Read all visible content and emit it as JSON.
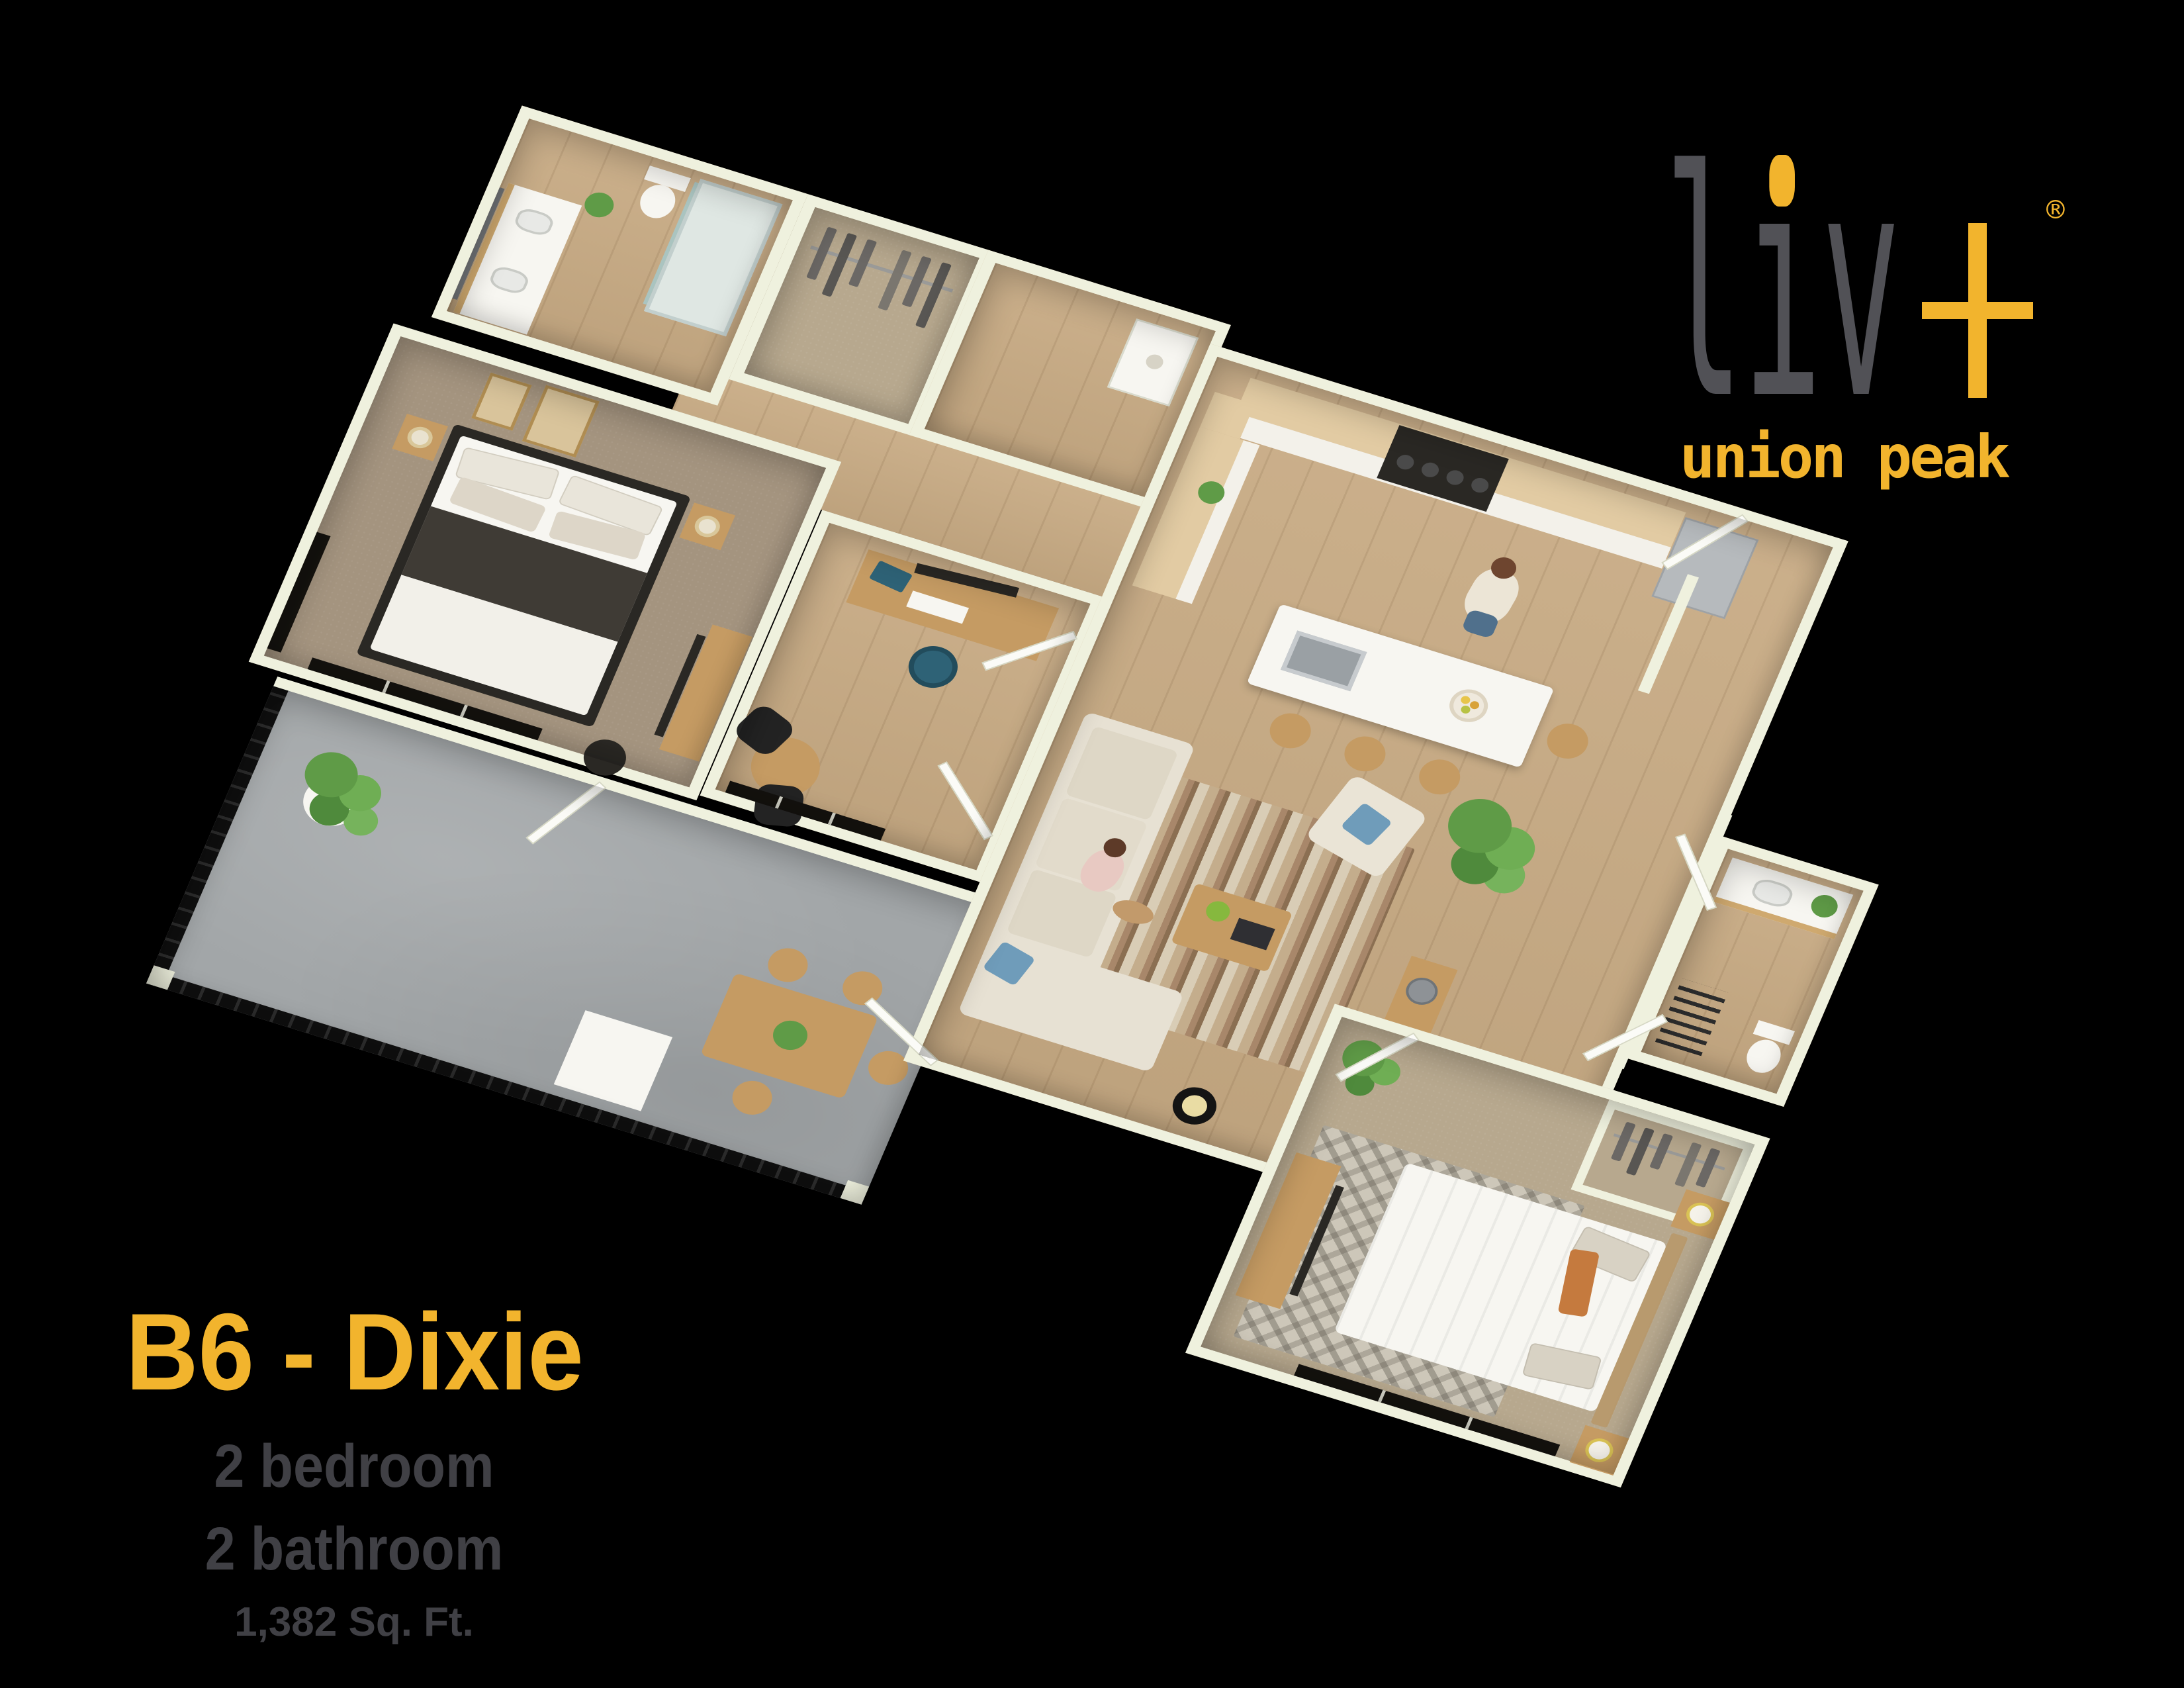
{
  "brand": {
    "logo_text": "liv",
    "plus_icon": "plus-icon",
    "registered_mark": "®",
    "subtitle": "union peak"
  },
  "unit": {
    "name": "B6 - Dixie",
    "bedrooms": "2 bedroom",
    "bathrooms": "2 bathroom",
    "area": "1,382 Sq. Ft."
  },
  "palette": {
    "background": "#000000",
    "brand_gold": "#f2b42d",
    "logo_gray": "#515156",
    "spec_gray": "#404045",
    "wall_cream": "#eff1de",
    "wood_floor": "#c8ab84",
    "carpet_bedroom1": "#a4947f",
    "carpet_bedroom2": "#b7a88e",
    "patio_concrete": "#a2a6a8",
    "cabinet_wood": "#e2cba3",
    "furniture_wood": "#c59b63",
    "dark_frame": "#2a2824",
    "teal_chair": "#2e6276",
    "blue_pillow": "#6f9cba",
    "plant_green": "#5f9b47",
    "stainless": "#b6babd"
  }
}
